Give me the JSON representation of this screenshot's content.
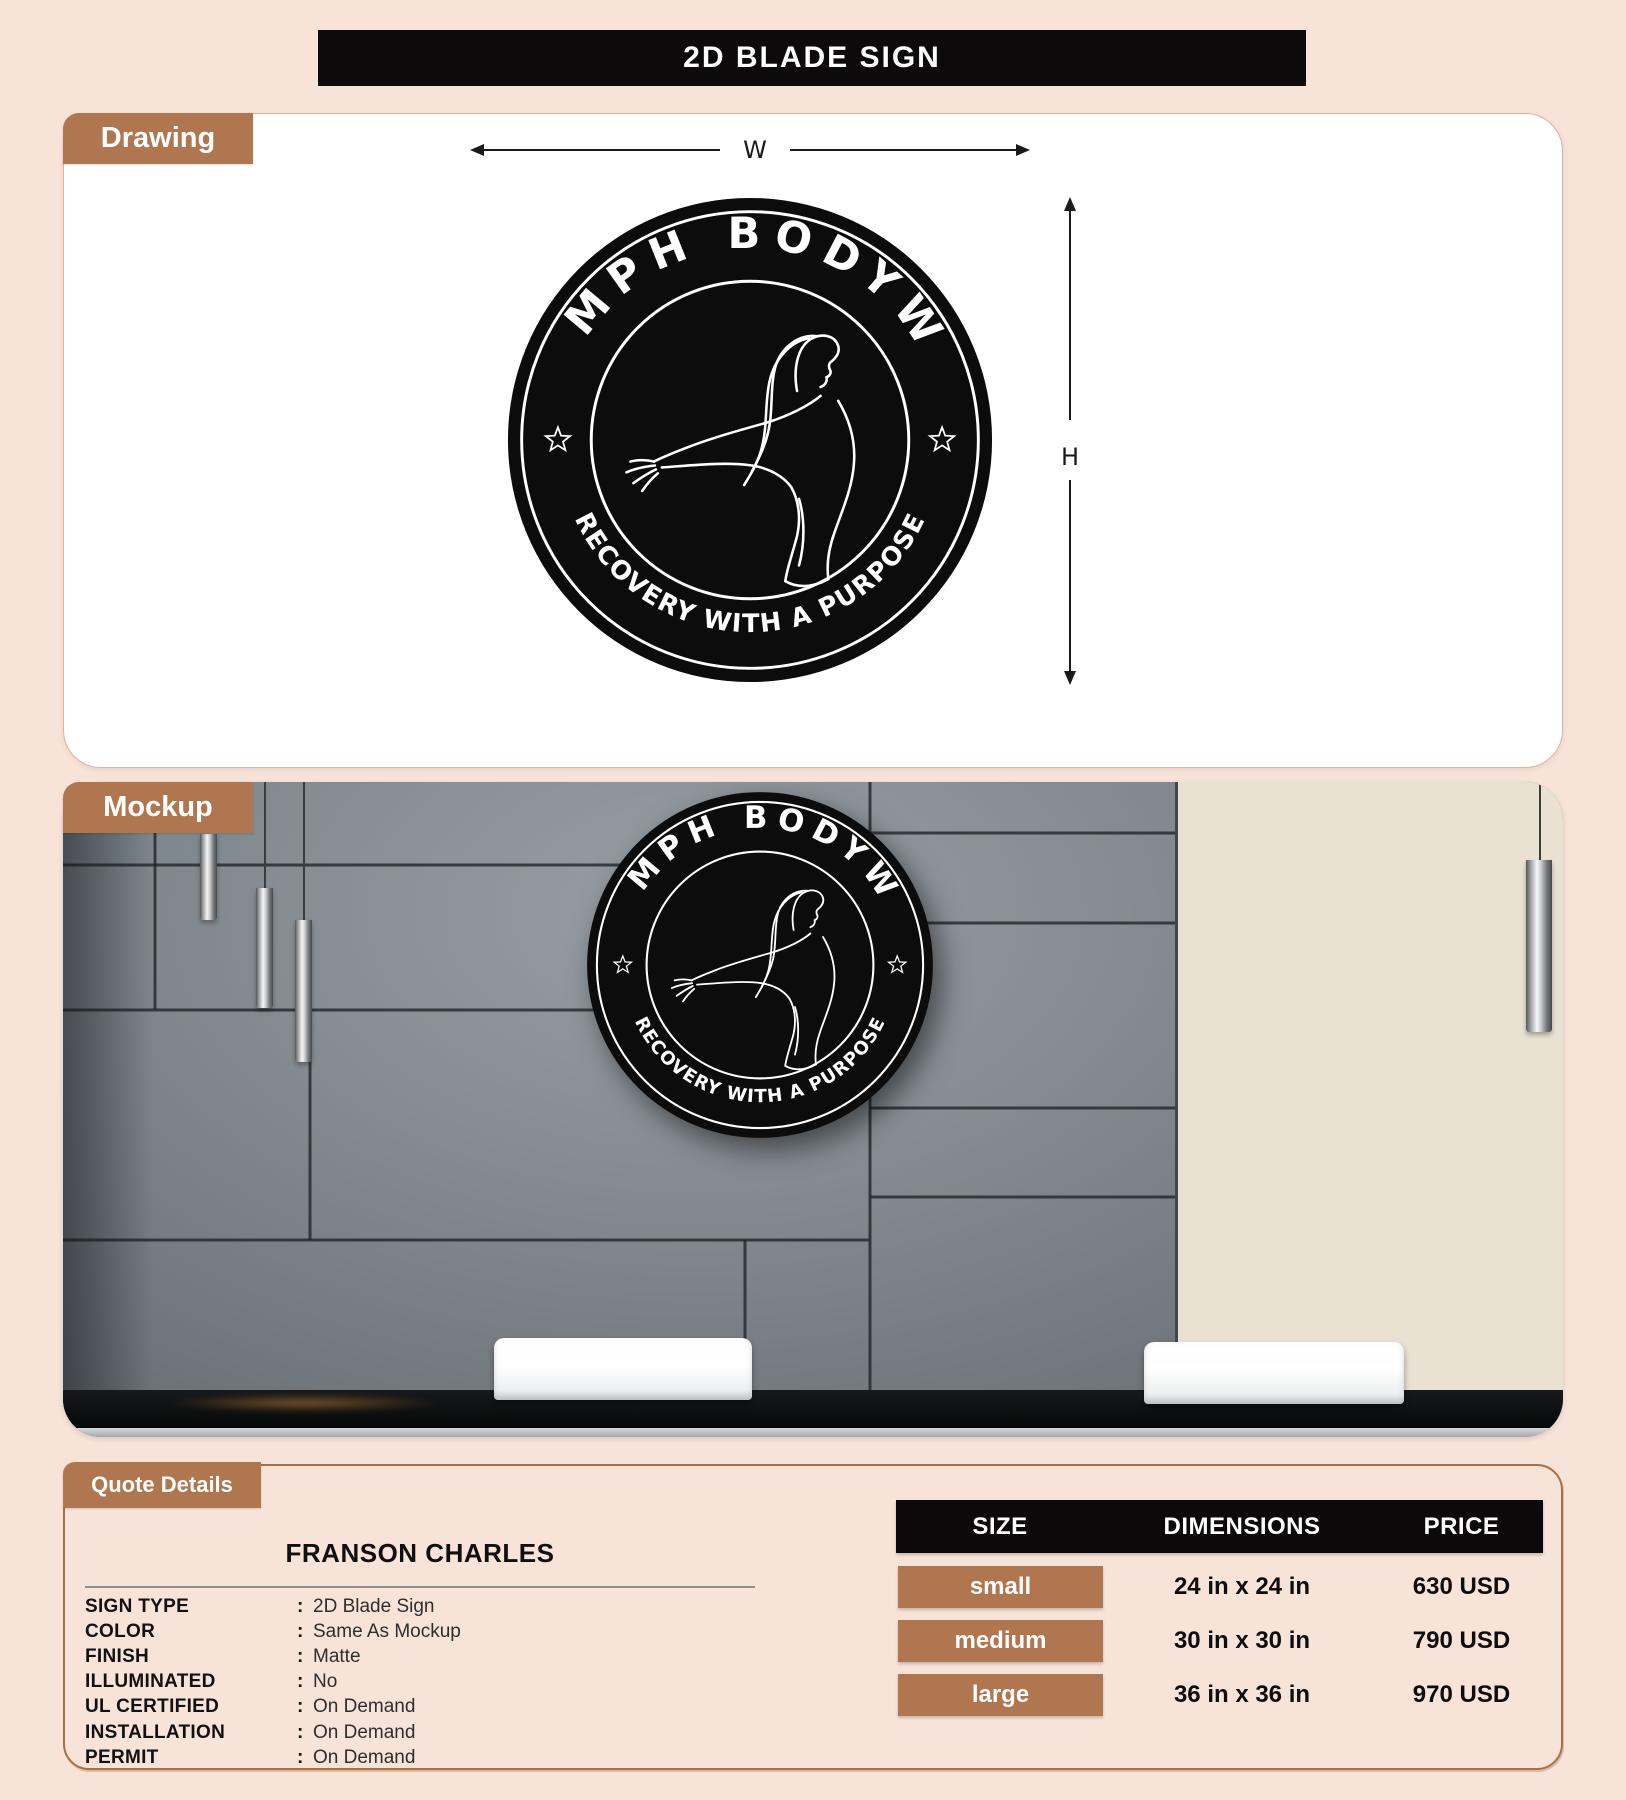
{
  "page": {
    "title": "2D BLADE SIGN"
  },
  "colors": {
    "accent_brown": "#b0764f",
    "banner_black": "#0c0a0a",
    "page_bg": "#f7e3d8",
    "sign_black": "#0d0c0d"
  },
  "drawing": {
    "tab_label": "Drawing",
    "width_label": "W",
    "height_label": "H"
  },
  "logo": {
    "top_text": "TRIUMPH BODYWORK",
    "bottom_text": "RECOVERY WITH A PURPOSE"
  },
  "mockup": {
    "tab_label": "Mockup"
  },
  "quote": {
    "tab_label": "Quote Details",
    "customer_name": "FRANSON CHARLES",
    "fields": [
      {
        "label": "SIGN TYPE",
        "separator": ":",
        "value": "2D Blade Sign"
      },
      {
        "label": "COLOR",
        "separator": ":",
        "value": "Same As Mockup"
      },
      {
        "label": "FINISH",
        "separator": ":",
        "value": "Matte"
      },
      {
        "label": "ILLUMINATED",
        "separator": ":",
        "value": "No"
      },
      {
        "label": "UL CERTIFIED",
        "separator": ":",
        "value": "On Demand"
      },
      {
        "label": "INSTALLATION",
        "separator": ":",
        "value": "On Demand"
      },
      {
        "label": "PERMIT",
        "separator": ":",
        "value": "On Demand"
      }
    ]
  },
  "pricing": {
    "headers": [
      "SIZE",
      "DIMENSIONS",
      "PRICE"
    ],
    "rows": [
      {
        "size": "small",
        "dimensions": "24 in x 24 in",
        "price": "630 USD"
      },
      {
        "size": "medium",
        "dimensions": "30 in x 30 in",
        "price": "790 USD"
      },
      {
        "size": "large",
        "dimensions": "36 in x 36 in",
        "price": "970 USD"
      }
    ]
  }
}
